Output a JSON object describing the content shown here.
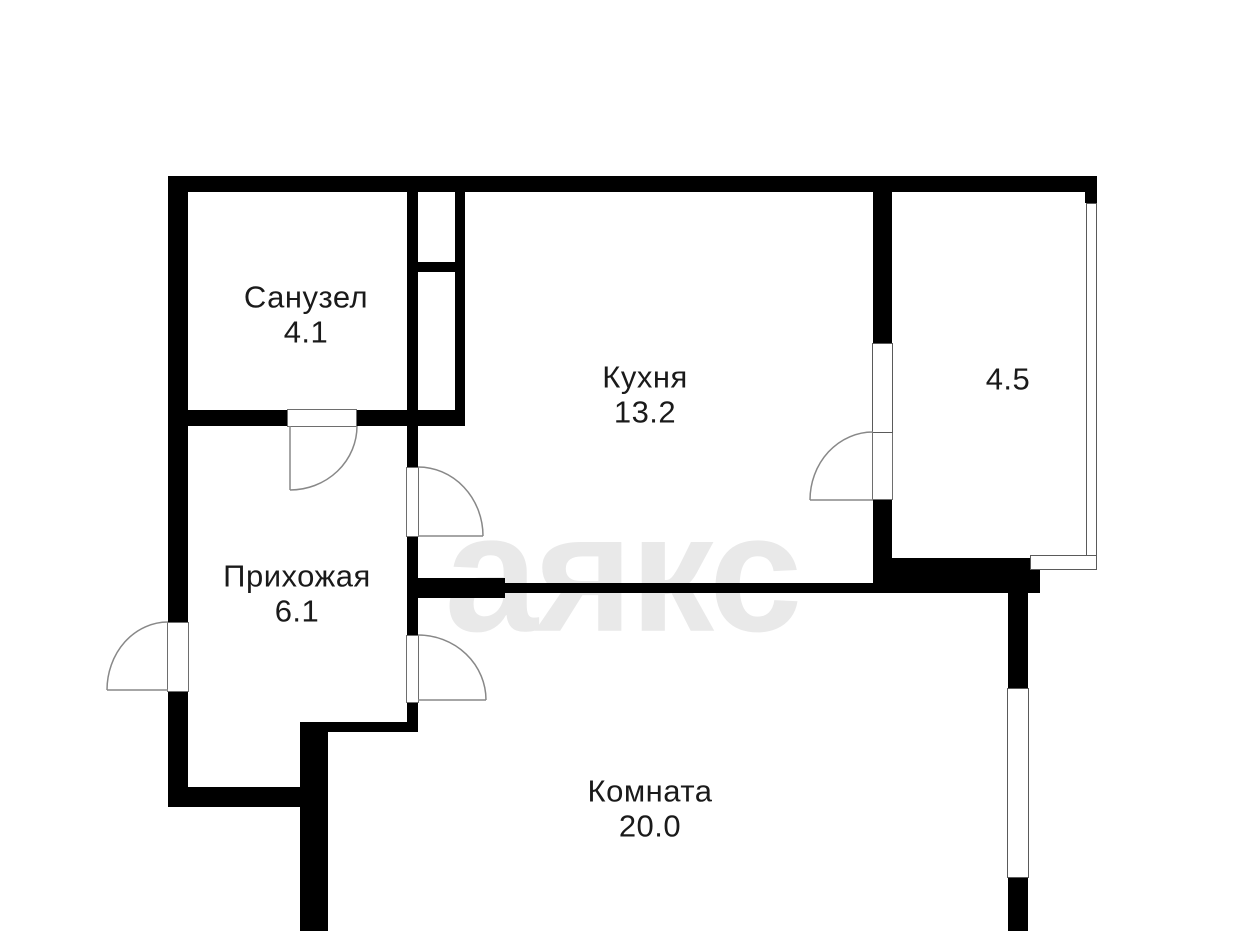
{
  "plan": {
    "watermark": "аякс",
    "rooms": [
      {
        "id": "sanuzel",
        "name": "Санузел",
        "area": "4.1"
      },
      {
        "id": "kuhnya",
        "name": "Кухня",
        "area": "13.2"
      },
      {
        "id": "prihozhaya",
        "name": "Прихожая",
        "area": "6.1"
      },
      {
        "id": "komnata",
        "name": "Комната",
        "area": "20.0"
      },
      {
        "id": "loggia",
        "name": "",
        "area": "4.5"
      }
    ],
    "colors": {
      "wall": "#000000",
      "thin_line": "#888888",
      "watermark": "#e9e9e9",
      "text": "#1a1a1a",
      "background": "#ffffff"
    }
  }
}
